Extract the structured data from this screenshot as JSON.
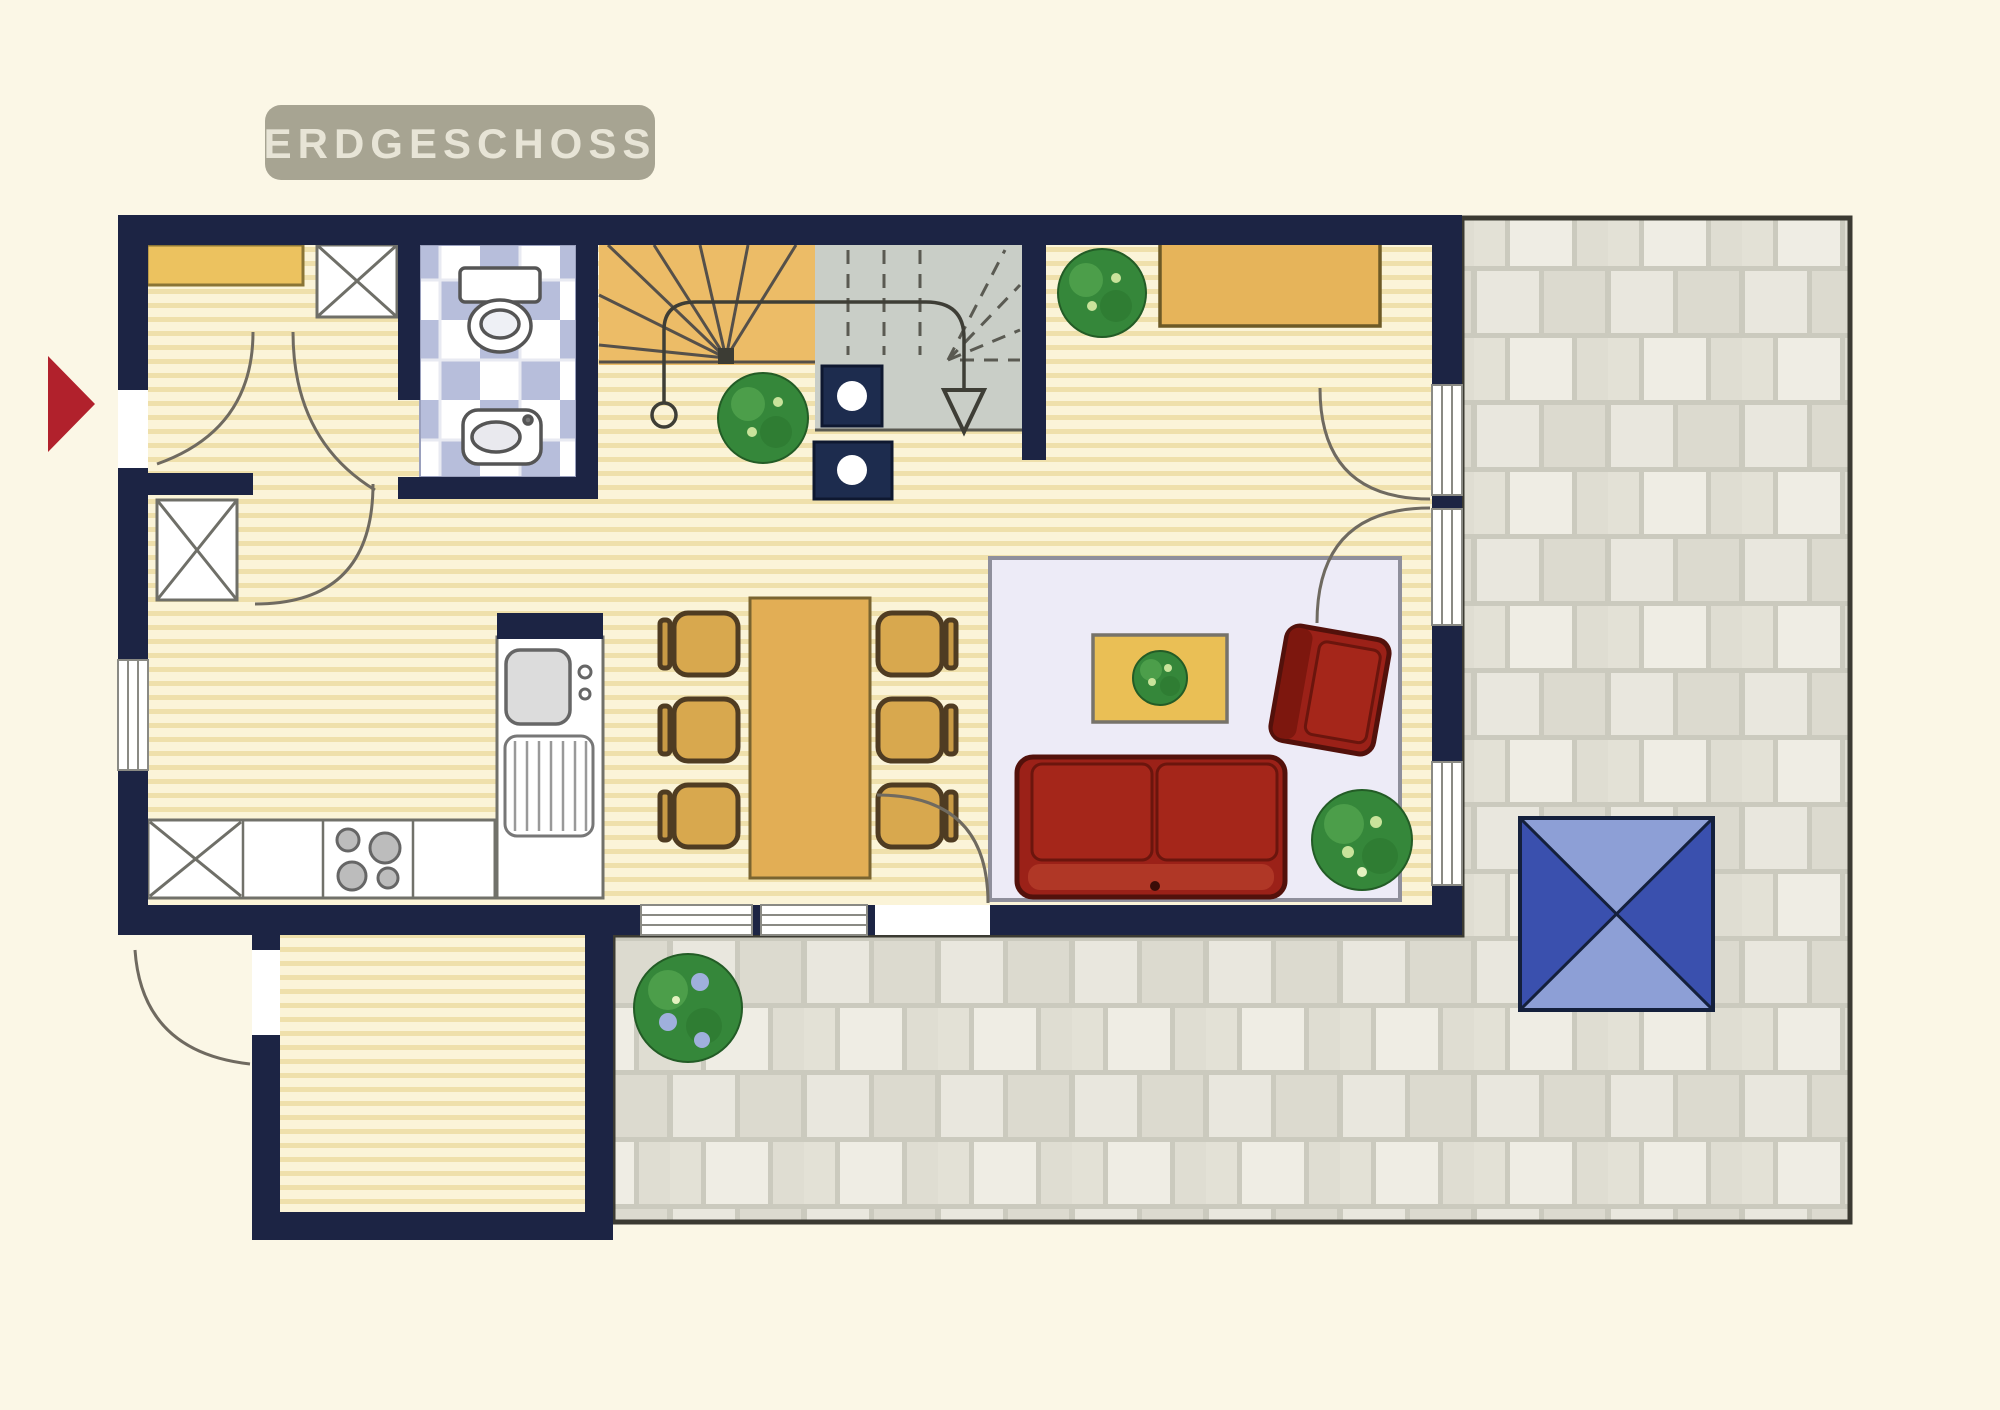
{
  "floor_plan": {
    "title": "ERDGESCHOSS",
    "entry_marker": "red-arrow-pointing-right-at-entrance",
    "colors": {
      "background": "#FBF7E6",
      "wall_navy": "#1C2444",
      "banner": "#A7A492",
      "banner_text": "#E7E4D6",
      "marker_red": "#B1212C",
      "wood_floor_base": "#FBF4D8",
      "wood_floor_stripe": "#EFE0AB",
      "stair_tread_tan": "#ECBC67",
      "stair_upper_gray": "#C9CEC7",
      "bath_tile_blue": "#B7BEDB",
      "rug": "#EDEBF7",
      "sofa_red": "#9B2118",
      "furniture_wood": "#E2AE55",
      "plant_green": "#35873A",
      "paver_light": "#E9E7DE",
      "paver_dark": "#DCDACF",
      "parasol_dark_blue": "#3A50AE",
      "parasol_light_blue": "#8D9FD6"
    },
    "rooms": [
      "entry-hall",
      "wc-bathroom",
      "winder-staircase",
      "kitchen",
      "dining-area",
      "living-area",
      "storage-annex",
      "terrace"
    ],
    "fixtures": [
      "wardrobe-shelf",
      "hall-cabinet",
      "toilet",
      "wash-basin",
      "kitchen-tall-cabinet",
      "kitchen-counter",
      "stove-four-burners",
      "kitchen-sink-with-drainer",
      "dining-table",
      "six-dining-chairs",
      "area-rug",
      "coffee-table-with-plant",
      "two-seat-sofa",
      "armchair",
      "sideboard",
      "parasol-table",
      "indoor-plants",
      "terrace-bush",
      "stair-down-arrow",
      "structural-posts"
    ]
  }
}
